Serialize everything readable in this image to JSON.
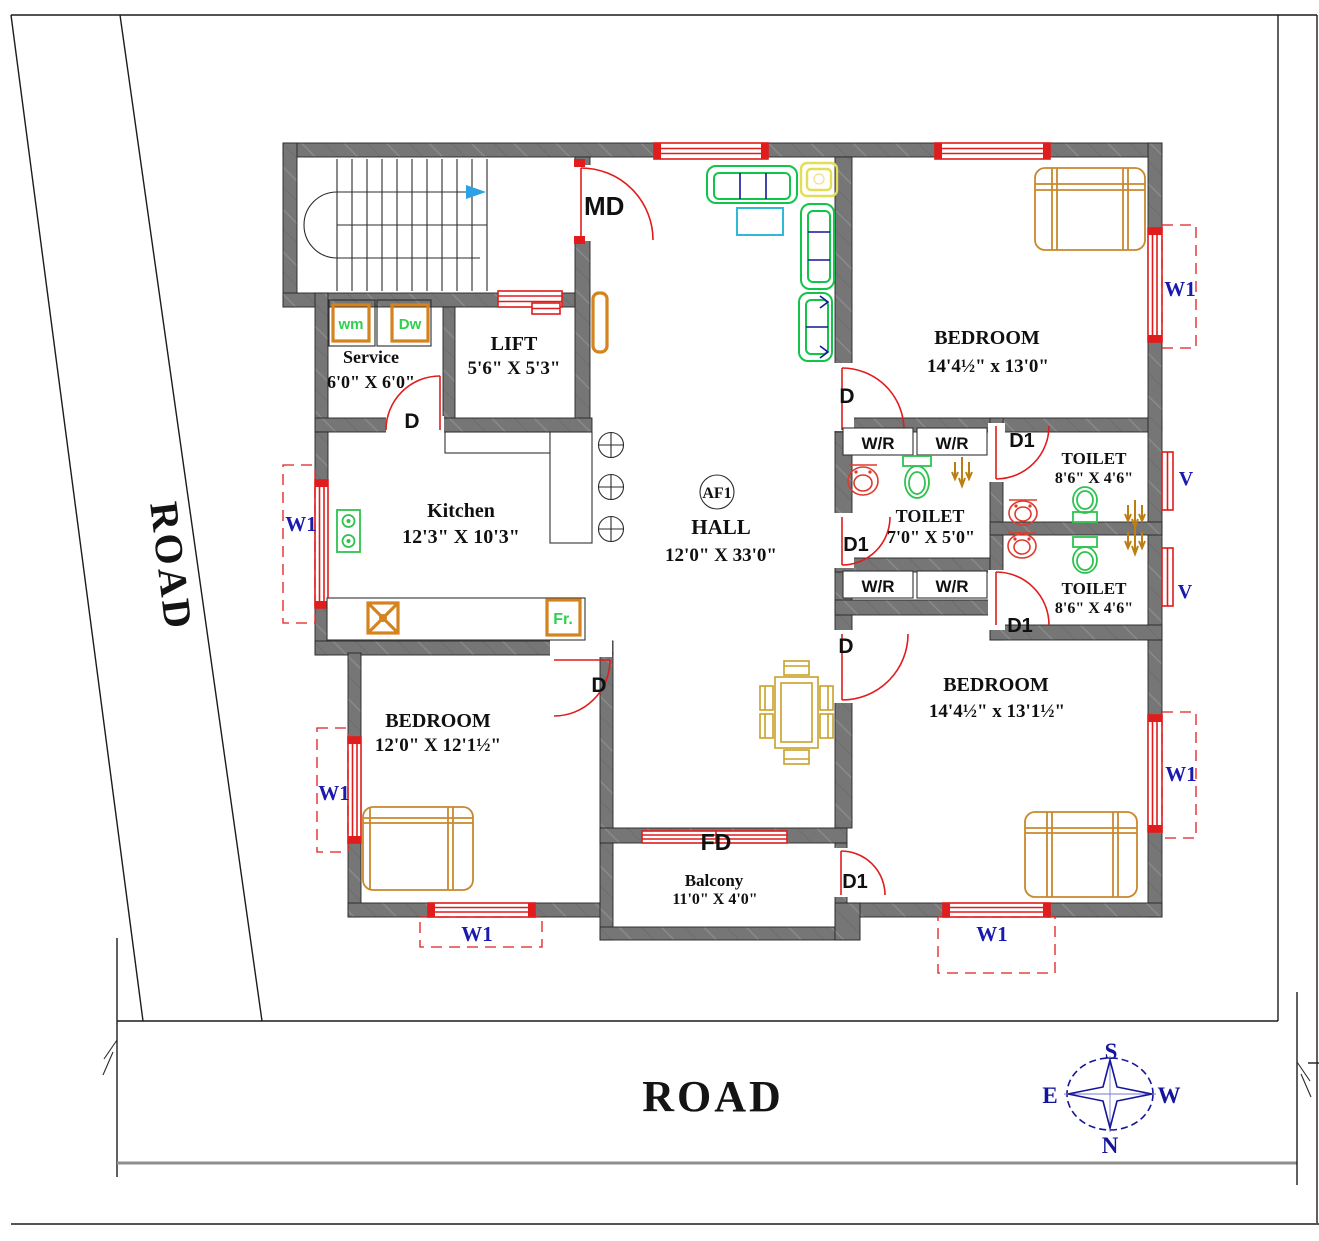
{
  "colors": {
    "wall": "#767676",
    "red": "#e01c1c",
    "bed": "#c9882e",
    "dining": "#c9a227",
    "sofa": "#12c44a",
    "accent_navy": "#15159c",
    "cyan": "#2fb9d6",
    "yellow": "#e2de55",
    "fixture_green": "#2fc24f",
    "fixture_red": "#de3b2e",
    "shower": "#bc7d12",
    "appliance": "#d4831f",
    "appliance_text": "#2ed04e",
    "label_blue": "#1a1aae",
    "compass": "#15159c",
    "gray_line": "#8f8f8f"
  },
  "roads": {
    "left": "ROAD",
    "bottom": "ROAD"
  },
  "compass": {
    "n": "N",
    "s": "S",
    "e": "E",
    "w": "W"
  },
  "rooms": {
    "hall": {
      "name": "HALL",
      "dims": "12'0\" X 33'0\""
    },
    "kitchen": {
      "name": "Kitchen",
      "dims": "12'3\" X 10'3\""
    },
    "service": {
      "name": "Service",
      "dims": "6'0\" X 6'0\""
    },
    "lift": {
      "name": "LIFT",
      "dims": "5'6\" X 5'3\""
    },
    "bedroom_tr": {
      "name": "BEDROOM",
      "dims": "14'4½\" x 13'0\""
    },
    "bedroom_br": {
      "name": "BEDROOM",
      "dims": "14'4½\" x 13'1½\""
    },
    "bedroom_bl": {
      "name": "BEDROOM",
      "dims": "12'0\" X 12'1½\""
    },
    "toilet_mid": {
      "name": "TOILET",
      "dims": "7'0\" X 5'0\""
    },
    "toilet_tr": {
      "name": "TOILET",
      "dims": "8'6\" X 4'6\""
    },
    "toilet_br": {
      "name": "TOILET",
      "dims": "8'6\" X 4'6\""
    },
    "balcony": {
      "name": "Balcony",
      "dims": "11'0\" X 4'0\""
    }
  },
  "labels": {
    "md": "MD",
    "d": "D",
    "d1": "D1",
    "fd": "FD",
    "wr": "W/R",
    "w1": "W1",
    "v": "V",
    "wm": "wm",
    "dw": "Dw",
    "fr": "Fr.",
    "af1": "AF1"
  }
}
